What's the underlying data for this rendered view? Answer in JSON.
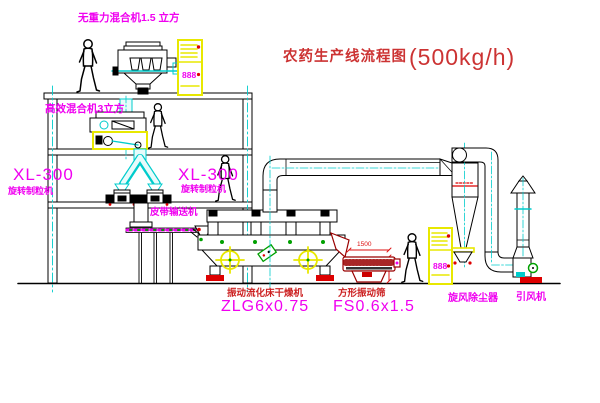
{
  "title": {
    "text": "农药生产线流程图",
    "capacity": "(500kg/h)"
  },
  "labels": {
    "gravity_free_mixer": "无重力混合机1.5 立方",
    "high_efficiency_mixer": "高效混合机3立方",
    "granulator_left_model": "XL-300",
    "granulator_left_name": "旋转制粒机",
    "granulator_mid_model": "XL-300",
    "granulator_mid_name": "旋转制粒机",
    "belt_conveyor": "皮带输送机",
    "dryer_name": "振动流化床干燥机",
    "dryer_model": "ZLG6x0.75",
    "screen_name": "方形振动筛",
    "screen_model": "FS0.6x1.5",
    "cyclone": "旋风除尘器",
    "fan": "引风机"
  },
  "dimensions": {
    "screen_length": "1500"
  },
  "cabinets": {
    "display_top": "888",
    "display_bottom": "888"
  },
  "colors": {
    "label_magenta": "#F000F0",
    "label_red": "#CC2222",
    "drawing_dark_red": "#990000",
    "centerline_cyan": "#00CCCC",
    "cabinet_yellow": "#E8E800",
    "dot_green": "#00A000",
    "base_red": "#DD0000",
    "line_black": "#000000"
  }
}
